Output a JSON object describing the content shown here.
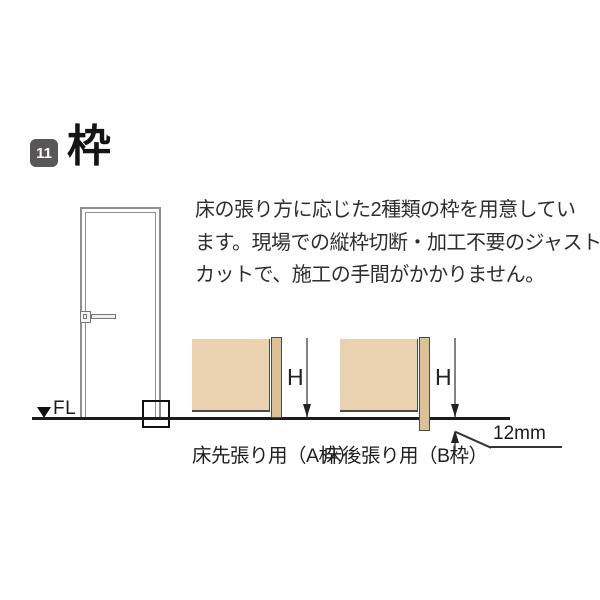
{
  "header": {
    "section_number": "11",
    "title": "枠"
  },
  "description": {
    "lines": [
      "床の張り方に応じた2種類の枠を用意してい",
      "ます。現場での縦枠切断・加工不要のジャスト",
      "カットで、施工の手間がかかりません。"
    ]
  },
  "floor": {
    "marker_icon": "down-triangle",
    "label": "FL"
  },
  "diagrams": {
    "a": {
      "caption": "床先張り用（A枠）",
      "dimension_label": "H"
    },
    "b": {
      "caption": "床後張り用（B枠）",
      "dimension_label": "H",
      "offset_label": "12mm"
    }
  },
  "colors": {
    "wall_fill": "#EAD2B0",
    "frame_fill": "#DCC096",
    "diagram_outline": "#4A4A42",
    "door_line": "#8F8F8F",
    "floor_line": "#1C1C1C",
    "badge_background": "#585656",
    "body_text": "#2E2E2E"
  }
}
